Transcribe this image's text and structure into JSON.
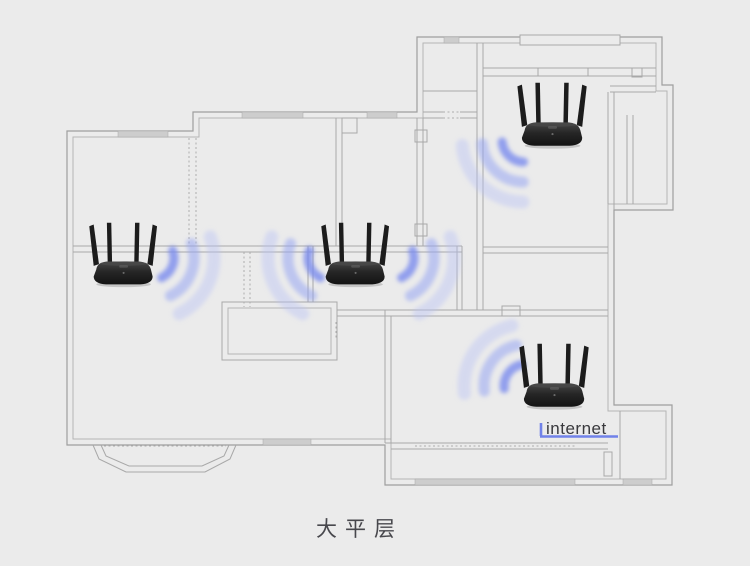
{
  "caption": {
    "text": "大平层"
  },
  "internet": {
    "label": "internet"
  },
  "diagram": {
    "type": "apartment-floorplan-wifi-coverage",
    "router_count": 4,
    "routers": [
      {
        "id": "router-left"
      },
      {
        "id": "router-top-right"
      },
      {
        "id": "router-center"
      },
      {
        "id": "router-bottom-right"
      }
    ],
    "icons": [
      "wifi-router-icon",
      "wifi-waves-icon"
    ],
    "colors": {
      "background": "#ebebeb",
      "wall_outer": "#9e9e9e",
      "wall_inner": "#b5b5b5",
      "window_fill": "#cdcdcd",
      "wifi_wave_strong": "#7b8cee",
      "wifi_wave_mid": "#97a5f2",
      "wifi_wave_light": "#b8c2f6",
      "internet_line": "#7182e9",
      "router_body": "#1f1f1f",
      "caption_text": "#48484d"
    }
  }
}
